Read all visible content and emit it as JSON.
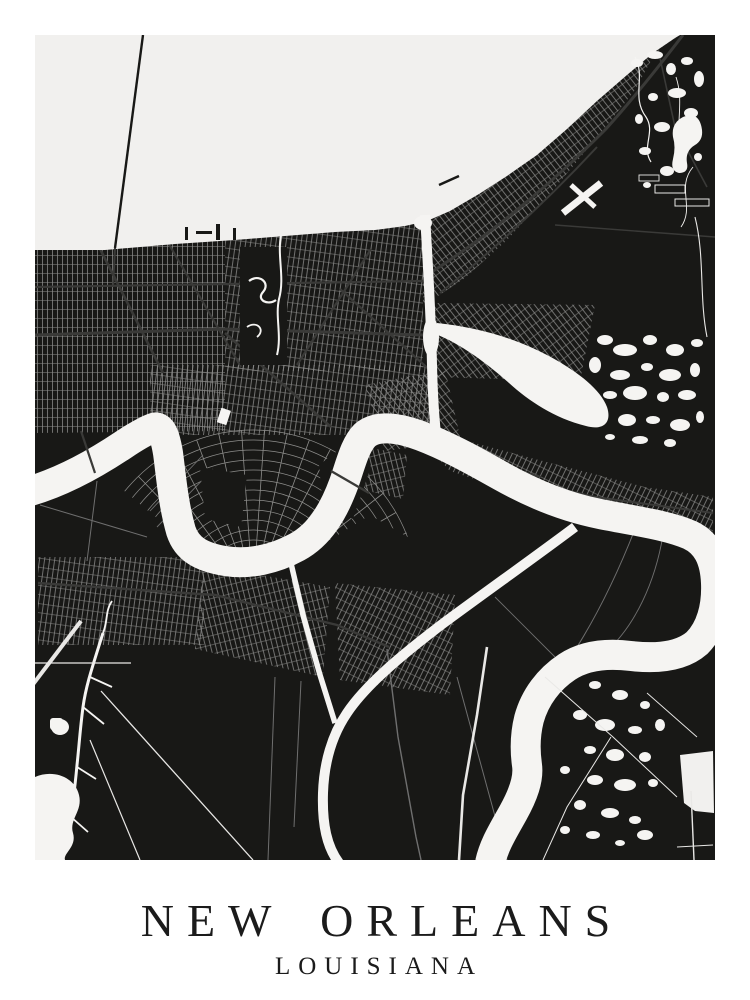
{
  "poster": {
    "title": "NEW ORLEANS",
    "subtitle": "LOUISIANA"
  },
  "theme": {
    "background": "#ffffff",
    "water": "#f1f0ee",
    "river": "#f5f4f2",
    "land": "#181816",
    "street": "#8e8e8c",
    "road_dark": "#3a3a38",
    "road_mid": "#6f6f6f",
    "road_light": "#e9e8e6",
    "text": "#1b1b1b"
  }
}
